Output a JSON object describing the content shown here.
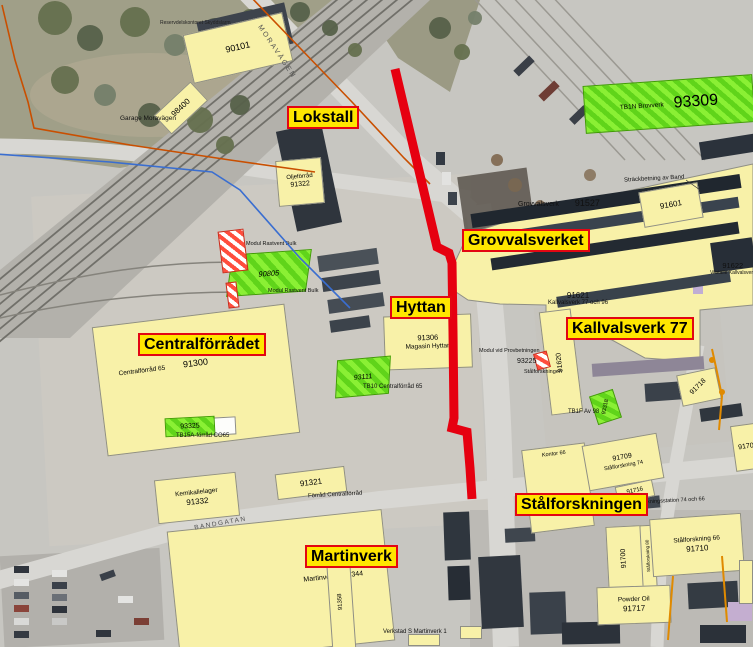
{
  "highlights": {
    "lokstall": "Lokstall",
    "grovvalsverket": "Grovvalsverket",
    "hyttan": "Hyttan",
    "centralforradet": "Centralförrådet",
    "kallvalsverk77": "Kallvalsverk 77",
    "stalforskningen": "Stålforskningen",
    "martinverk": "Martinverk"
  },
  "buildings": {
    "b90101": {
      "num": "90101"
    },
    "b98400": {
      "num": "98400"
    },
    "b91322": {
      "name": "Oljeförråd",
      "num": "91322"
    },
    "b91300": {
      "name": "Centralförråd 65",
      "num": "91300"
    },
    "b91527": {
      "name": "Grovvalsverk",
      "num": "91527"
    },
    "b91601": {
      "num": "91601"
    },
    "b91622": {
      "num": "91622",
      "name": "Vitställe Kallvalsverk"
    },
    "b91621": {
      "num": "91621",
      "name": "Kallvalsverk 77 och 96"
    },
    "b91620": {
      "num": "91620"
    },
    "b91718": {
      "num": "91718"
    },
    "b91706": {
      "num": "91706"
    },
    "bkontor": {
      "name": "Kontor 66"
    },
    "b91709": {
      "num": "91709",
      "name": "Stålforskning 74"
    },
    "b91716": {
      "num": "91716"
    },
    "b91700": {
      "num": "91700"
    },
    "bkorridor": {
      "name": "Stålforskning 80"
    },
    "b91710": {
      "name": "Stålforskning 66",
      "num": "91710"
    },
    "b91717": {
      "name": "Powder Oil",
      "num": "91717"
    },
    "b91332": {
      "name": "Kemikalielager",
      "num": "91332"
    },
    "b91321": {
      "num": "91321"
    },
    "b91344": {
      "name": "Martinverk 1 91344"
    },
    "b91306": {
      "num": "91306",
      "name": "Magasin Hyttan"
    },
    "b91358": {
      "num": "91358"
    }
  },
  "green_areas": {
    "g93309": {
      "name": "TB1N Brovverk",
      "num": "93309"
    },
    "g90805": {
      "num": "90805"
    },
    "g93111": {
      "num": "93111"
    },
    "g93325": {
      "num": "93325"
    },
    "g93318": {
      "num": "93318"
    }
  },
  "annotations": {
    "reservdels": "Reservdelskontoret Skyddslarm",
    "garage": "Garage Moravägen",
    "modul_bulk_a": "Modul Rastvent Bulk",
    "modul_bulk_b": "Modul Rastvent Bulk",
    "strackbetning": "Sträckbetning av Band",
    "modul_prov": "Modul vid Provbetningen",
    "m93225": "93225",
    "stalforskningen_liten": "Stålforskningen",
    "tb10": "TB10 Centralförråd 65",
    "tb15a": "TB15A-förråd CO65",
    "tb1f": "TB1F Av 98",
    "forrad_central": "Förråd Centralförråd",
    "forskningsstation": "Forskningsstation 74 och 66",
    "verkstad": "Verkstad S Martinverk 1"
  },
  "streets": {
    "moravagen": "MORAVÄGEN",
    "bandgatan": "BANDGATAN"
  },
  "colors": {
    "building_fill": "#f8f1a8",
    "highlight_bg": "#ffe600",
    "highlight_border": "#e30613",
    "route_red": "#e60010",
    "green_area": "#60d41a",
    "boundary_orange": "#c94f00",
    "line_blue": "#3a6ed0"
  }
}
